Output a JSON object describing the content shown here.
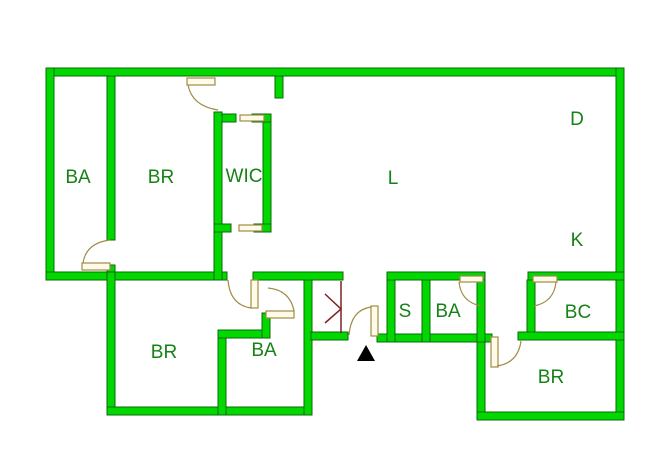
{
  "floorplan": {
    "type": "apartment-floor-plan",
    "colors": {
      "wall_fill": "#00d800",
      "wall_outline": "#0a6a0a",
      "label_text": "#168216",
      "door_outline": "#a08c46",
      "door_fill": "#fffbe8",
      "utility_marker": "#7b2424",
      "entrance_marker": "#000000",
      "background": "#ffffff"
    },
    "rooms": [
      {
        "id": "ba-upper-left",
        "label": "BA"
      },
      {
        "id": "br-upper",
        "label": "BR"
      },
      {
        "id": "wic",
        "label": "WIC"
      },
      {
        "id": "living",
        "label": "L"
      },
      {
        "id": "dining",
        "label": "D"
      },
      {
        "id": "kitchen",
        "label": "K"
      },
      {
        "id": "br-lower-left",
        "label": "BR"
      },
      {
        "id": "ba-lower-left",
        "label": "BA"
      },
      {
        "id": "storage",
        "label": "S"
      },
      {
        "id": "ba-hall",
        "label": "BA"
      },
      {
        "id": "bc",
        "label": "BC"
      },
      {
        "id": "br-lower-right",
        "label": "BR"
      }
    ],
    "markers": {
      "entrance": "black triangle at main entry",
      "utility": "maroon chevron in utility closet"
    }
  }
}
